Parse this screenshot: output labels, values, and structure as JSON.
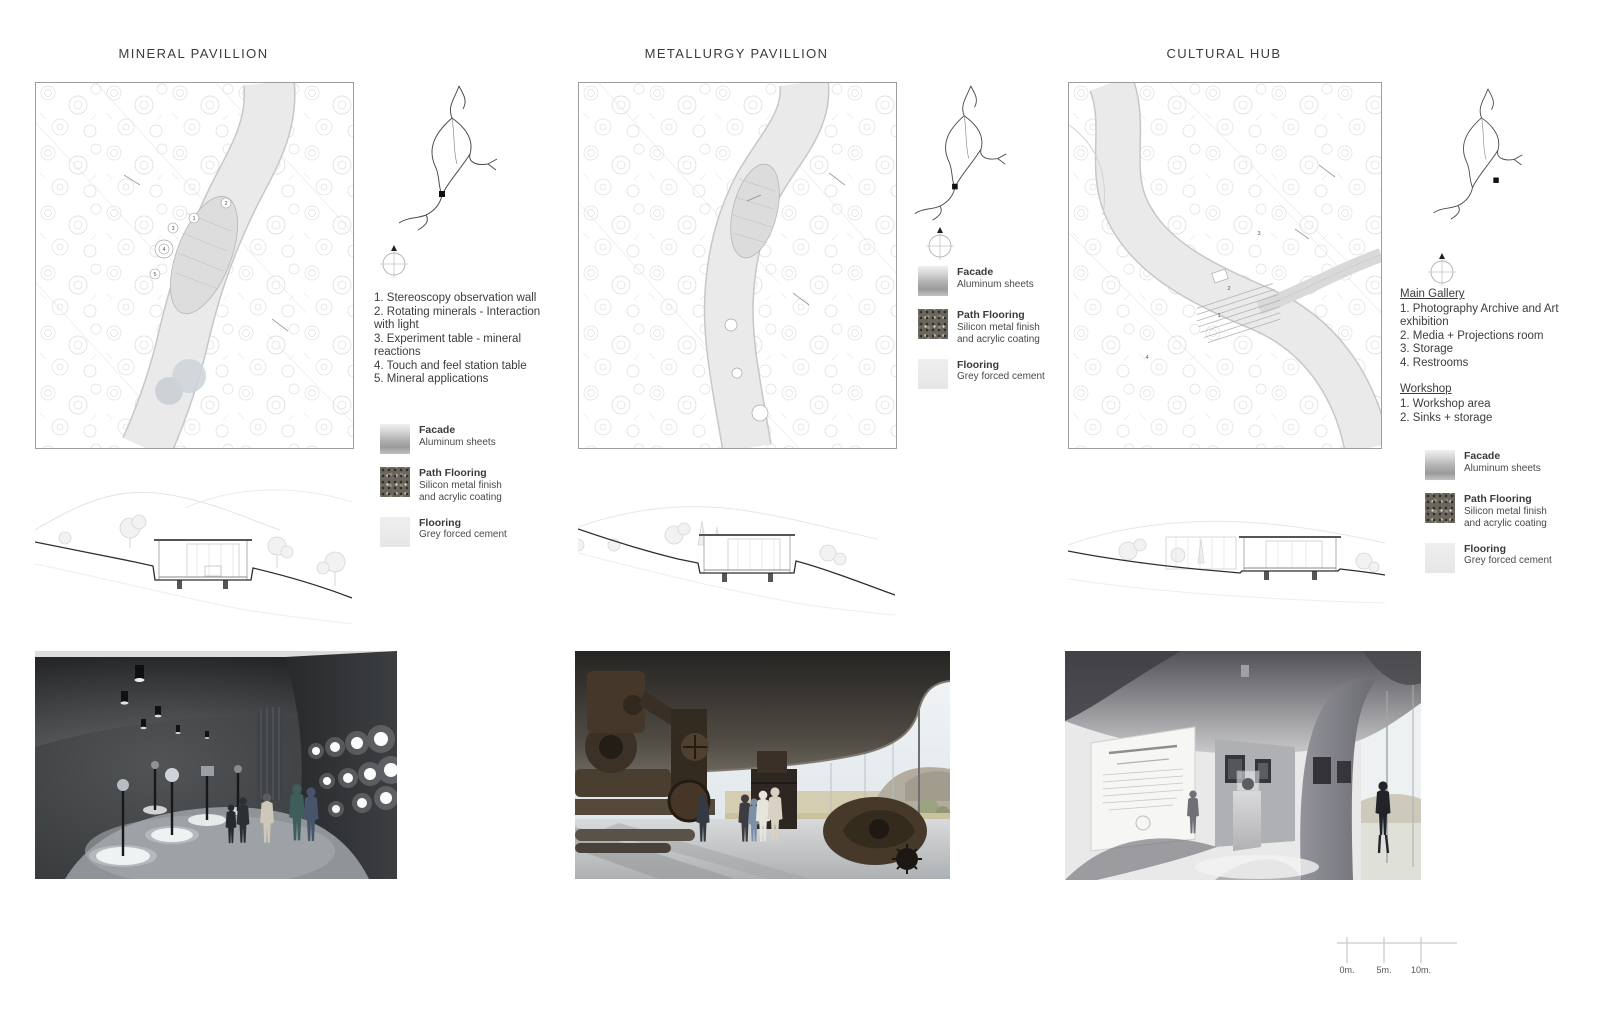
{
  "board": {
    "background": "#ffffff",
    "columns": [
      {
        "title": "MINERAL PAVILLION",
        "program": {
          "items": [
            "1. Stereoscopy observation wall",
            "2. Rotating minerals - Interaction with light",
            "3. Experiment table - mineral reactions",
            "4. Touch and feel station table",
            "5. Mineral applications"
          ]
        },
        "plan_markers": [
          "1",
          "2",
          "3",
          "4",
          "5"
        ]
      },
      {
        "title": "METALLURGY PAVILLION"
      },
      {
        "title": "CULTURAL HUB",
        "program_groups": [
          {
            "heading": "Main Gallery",
            "items": [
              "1. Photography Archive and Art exhibition",
              "2. Media + Projections room",
              "3. Storage",
              "4. Restrooms"
            ]
          },
          {
            "heading": "Workshop",
            "items": [
              "1. Workshop area",
              "2. Sinks + storage"
            ]
          }
        ],
        "plan_markers": [
          "1",
          "2",
          "3",
          "4"
        ]
      }
    ]
  },
  "legend": {
    "entries": [
      {
        "label": "Facade",
        "description": "Aluminum sheets",
        "swatch": "aluminum-gradient"
      },
      {
        "label": "Path Flooring",
        "description": "Silicon metal finish and acrylic coating",
        "swatch": "dark-granular"
      },
      {
        "label": "Flooring",
        "description": "Grey forced cement",
        "swatch": "light-grey"
      }
    ]
  },
  "scale_bar": {
    "labels": [
      "0m.",
      "5m.",
      "10m."
    ]
  },
  "icons": {
    "compass": "north-compass-icon",
    "locator": "site-locator-map"
  },
  "colors": {
    "title_text": "#3c3c3c",
    "plan_path": "#e9e9e9",
    "terrain_line": "#2e2e2e",
    "render1_wall": "#3a3d40",
    "render2_canopy": "#3a362f",
    "render3_ceiling": "#77777c"
  }
}
